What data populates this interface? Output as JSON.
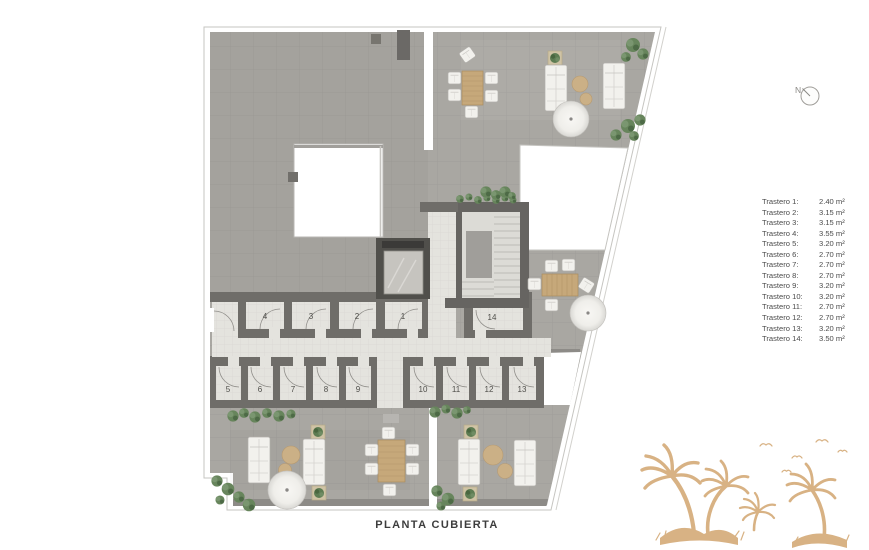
{
  "title": "PLANTA CUBIERTA",
  "compass": {
    "label": "N"
  },
  "legend": {
    "items": [
      {
        "label": "Trastero 1:",
        "area": "2.40 m²"
      },
      {
        "label": "Trastero 2:",
        "area": "3.15 m²"
      },
      {
        "label": "Trastero 3:",
        "area": "3.15 m²"
      },
      {
        "label": "Trastero 4:",
        "area": "3.55 m²"
      },
      {
        "label": "Trastero 5:",
        "area": "3.20 m²"
      },
      {
        "label": "Trastero 6:",
        "area": "2.70 m²"
      },
      {
        "label": "Trastero 7:",
        "area": "2.70 m²"
      },
      {
        "label": "Trastero 8:",
        "area": "2.70 m²"
      },
      {
        "label": "Trastero 9:",
        "area": "3.20 m²"
      },
      {
        "label": "Trastero 10:",
        "area": "3.20 m²"
      },
      {
        "label": "Trastero 11:",
        "area": "2.70 m²"
      },
      {
        "label": "Trastero 12:",
        "area": "2.70 m²"
      },
      {
        "label": "Trastero 13:",
        "area": "3.20 m²"
      },
      {
        "label": "Trastero 14:",
        "area": "3.50 m²"
      }
    ]
  },
  "plan": {
    "room_numbers": [
      "1",
      "2",
      "3",
      "4",
      "5",
      "6",
      "7",
      "8",
      "9",
      "10",
      "11",
      "12",
      "13",
      "14"
    ]
  },
  "colors": {
    "concrete": "#a9a7a2",
    "floor_tile": "#e4e3de",
    "wall": "#6f6d69",
    "wood": "#c6a87a",
    "greenery": "#67855c",
    "palm_watermark": "#d8b284"
  }
}
